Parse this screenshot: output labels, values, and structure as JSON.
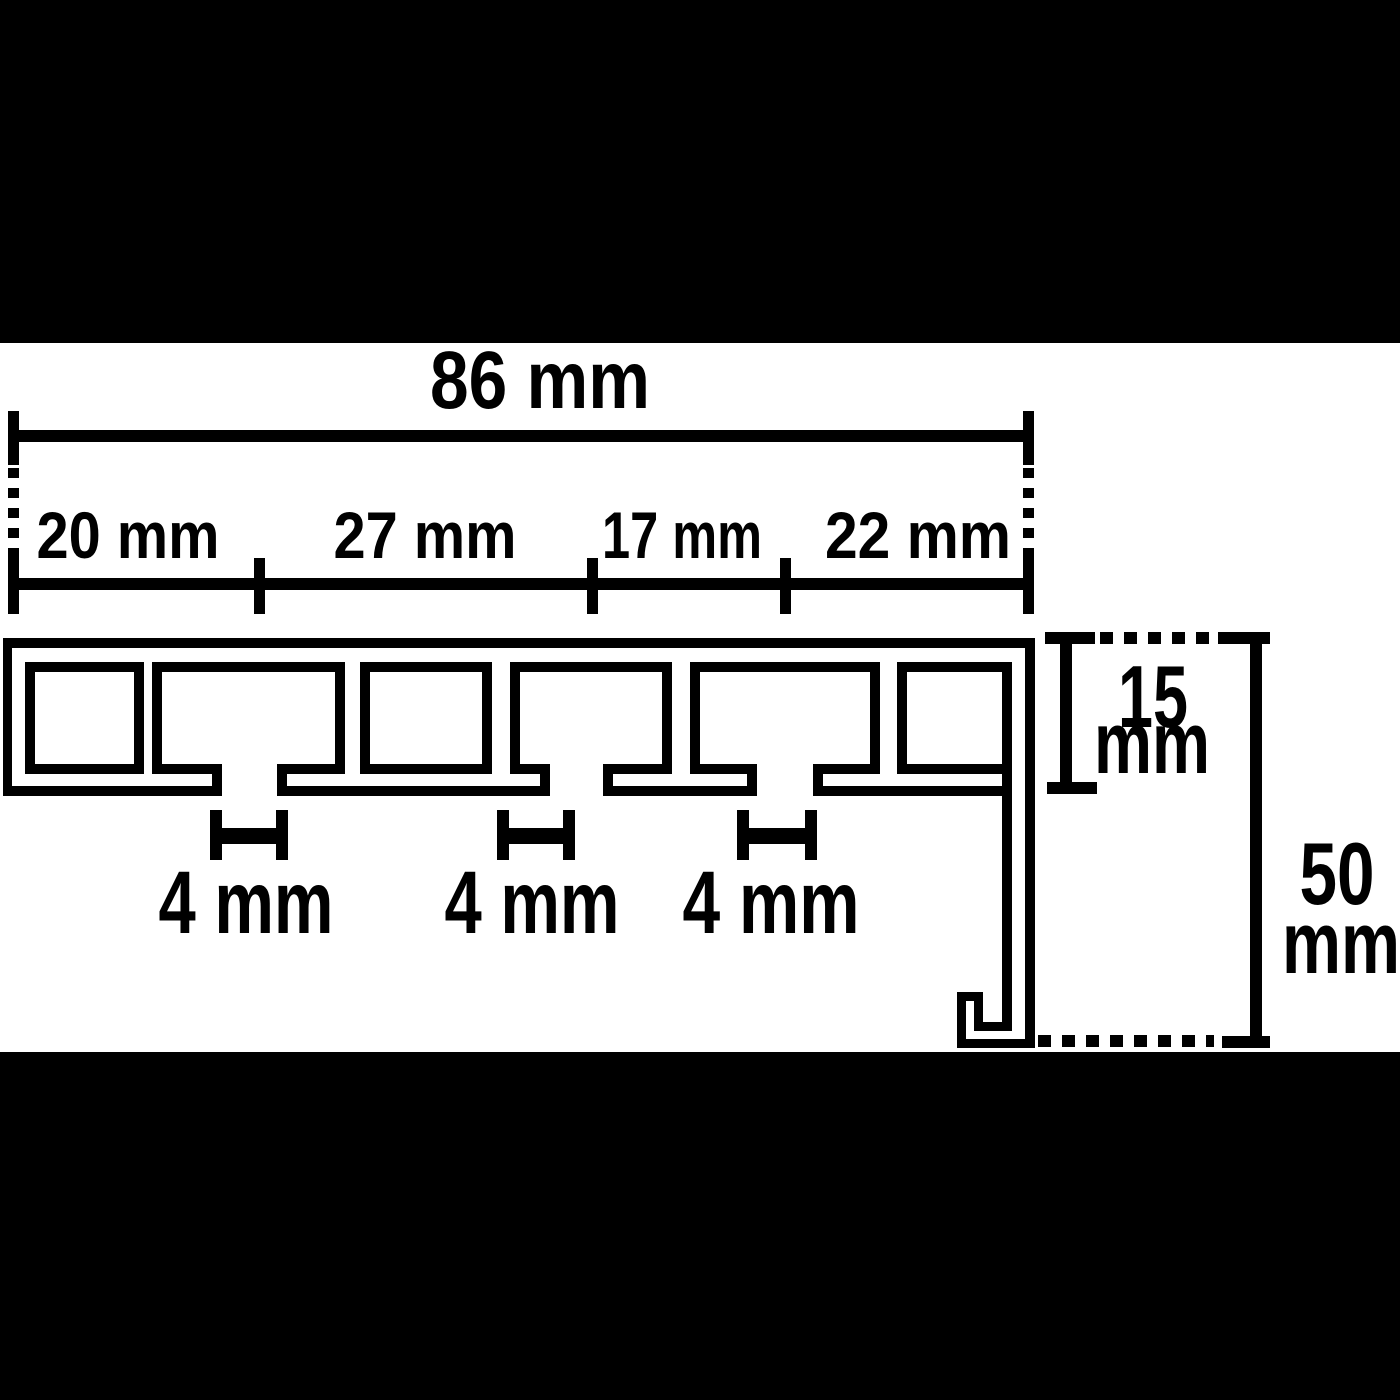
{
  "meta": {
    "description": "Technical cross-section dimension drawing of a 3-track curtain rail profile on white, letterboxed by black bars"
  },
  "dimensions_mm": {
    "overall_width": 86,
    "width_segments": [
      20,
      27,
      17,
      22
    ],
    "slot_widths": [
      4,
      4,
      4
    ],
    "front_height": 15,
    "total_height": 50
  },
  "labels": {
    "overall_width": "86 mm",
    "segments": [
      "20 mm",
      "27 mm",
      "17 mm",
      "22 mm"
    ],
    "slots": [
      "4 mm",
      "4 mm",
      "4 mm"
    ],
    "front_height_value": "15",
    "front_height_unit": "mm",
    "total_height_value": "50",
    "total_height_unit": "mm"
  },
  "colors": {
    "ink": "#000000",
    "paper": "#ffffff",
    "letterbox": "#000000"
  }
}
